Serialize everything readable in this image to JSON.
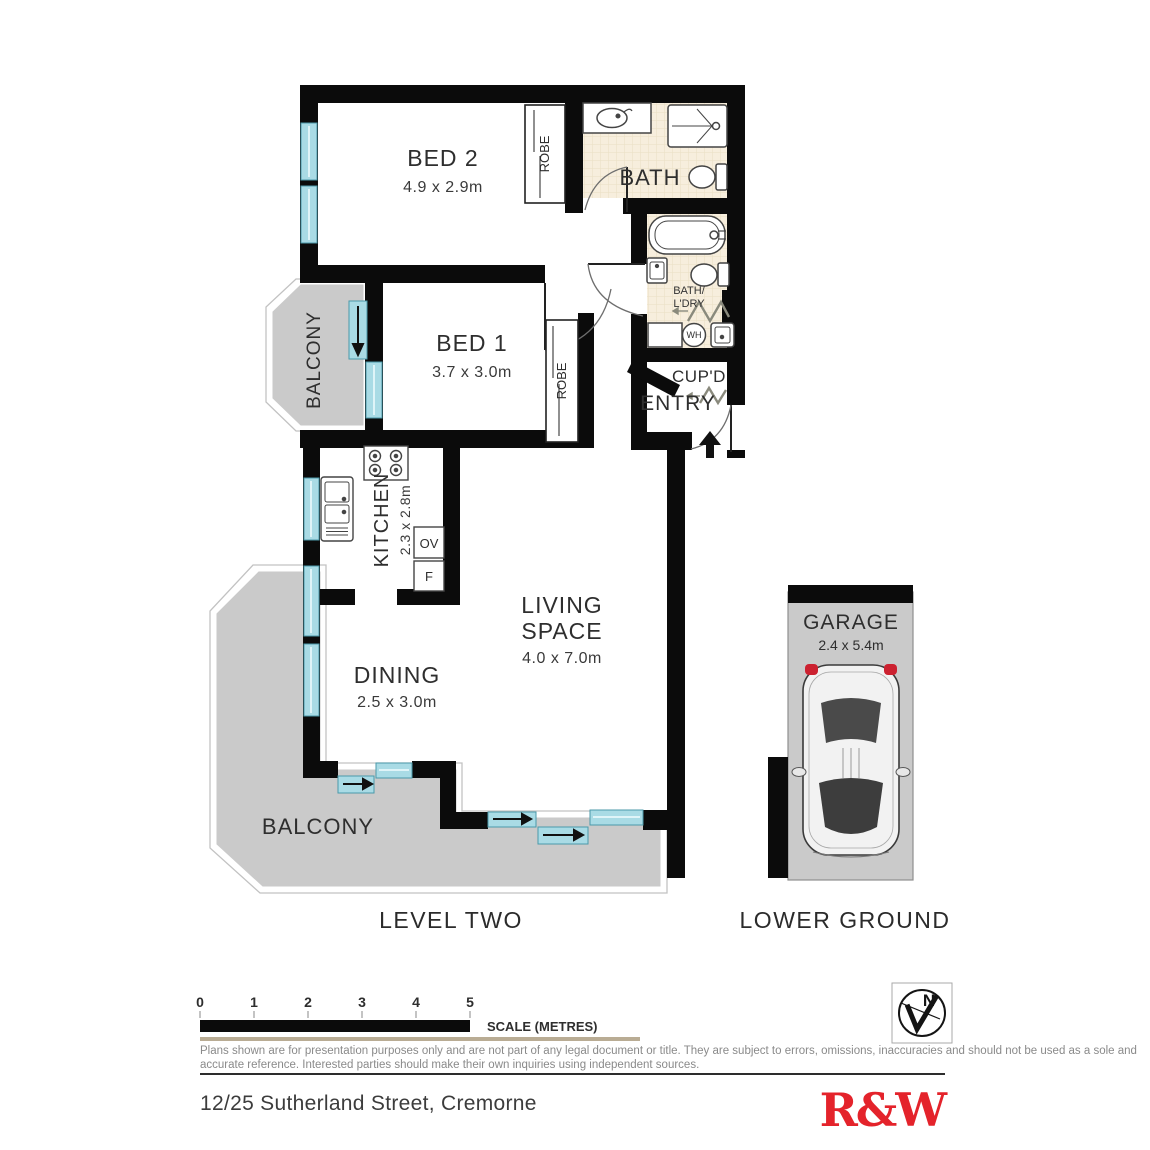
{
  "plan": {
    "rooms": {
      "bed2": {
        "name": "BED 2",
        "dims": "4.9 x 2.9m"
      },
      "bed1": {
        "name": "BED 1",
        "dims": "3.7 x 3.0m"
      },
      "bath": {
        "name": "BATH"
      },
      "bath_laundry": {
        "line1": "BATH/",
        "line2": "L'DRY"
      },
      "cupboard": {
        "name": "CUP'D"
      },
      "entry": {
        "name": "ENTRY"
      },
      "kitchen": {
        "name": "KITCHEN",
        "dims": "2.3 x 2.8m"
      },
      "living": {
        "line1": "LIVING",
        "line2": "SPACE",
        "dims": "4.0 x 7.0m"
      },
      "dining": {
        "name": "DINING",
        "dims": "2.5 x 3.0m"
      },
      "balcony_upper": {
        "name": "BALCONY"
      },
      "balcony_lower": {
        "name": "BALCONY"
      },
      "garage": {
        "name": "GARAGE",
        "dims": "2.4 x 5.4m"
      },
      "robe_bed2": {
        "name": "ROBE"
      },
      "robe_bed1": {
        "name": "ROBE"
      },
      "water_heater": {
        "abbr": "WH"
      },
      "oven": {
        "abbr": "OV"
      },
      "fridge": {
        "abbr": "F"
      }
    },
    "levels": {
      "left": "LEVEL TWO",
      "right": "LOWER GROUND"
    }
  },
  "footer": {
    "scale": {
      "ticks": [
        "0",
        "1",
        "2",
        "3",
        "4",
        "5"
      ],
      "label": "SCALE (METRES)"
    },
    "disclaimer": {
      "line1": "Plans shown are for presentation purposes only and are not part of any legal document or title. They are subject to errors, omissions, inaccuracies and should not be used as a sole and",
      "line2": "accurate reference. Interested parties should make their own inquiries using independent sources."
    },
    "address": "12/25 Sutherland Street, Cremorne",
    "brand": "R&W",
    "compass": {
      "letter": "N"
    }
  },
  "colors": {
    "wall": "#0b0b0b",
    "window": "#a9dbe5",
    "balcony": "#cacaca",
    "bath_floor": "#f7eedd",
    "brand_red": "#e4232b"
  }
}
